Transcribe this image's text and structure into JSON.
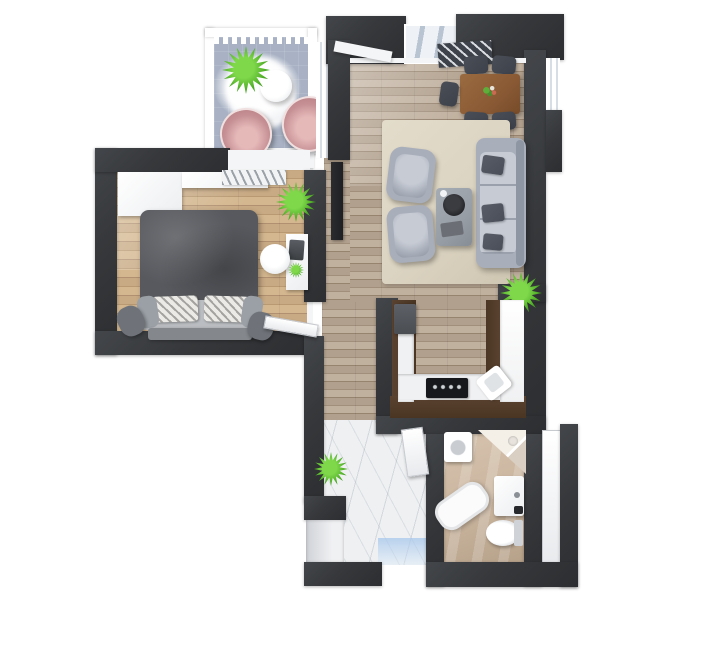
{
  "scene": {
    "type": "3d-floor-plan",
    "description": "Top-down 3D rendered floor plan of a one-bedroom apartment with balcony, bedroom, open living-dining room, U-shaped kitchen, hallway and bathroom on a white background"
  },
  "colors": {
    "wall": "#36383b",
    "trim_white": "#f4f5f6",
    "wood_bedroom": "#c8aa84",
    "wood_bedroom_dark": "#b89972",
    "wood_living": "#b1a08d",
    "wood_living_dark": "#a18f7c",
    "marble_white": "#eef0f2",
    "bath_tile": "#c9b49e",
    "balcony_floor": "#a8b2c4",
    "cabinet_brown": "#4a3523",
    "counter_white": "#f0f1f2",
    "rug_cream": "#dcd4c2",
    "rug_dark": "#3e424a",
    "sofa_gray": "#a8aeba",
    "sofa_shadow": "#8f96a3",
    "pillow_dark": "#4a4e58",
    "table_wood": "#8a5a35",
    "chair_dark": "#3d414a",
    "bed_duvet": "#57595e",
    "bed_light": "#babdc1",
    "chair_pink": "#c58f93",
    "chair_pink_dark": "#b47a80",
    "plant_green": "#4aa823",
    "plant_green_light": "#7fd84a",
    "appliance_dark": "#4a4e53",
    "cooktop_black": "#17181b"
  },
  "rooms": [
    {
      "name": "balcony",
      "items": [
        "railing",
        "potted-plant",
        "white-fluffy-rug",
        "round-side-table",
        "pink-lounge-chair",
        "pink-lounge-chair"
      ]
    },
    {
      "name": "bedroom",
      "items": [
        "wardrobe",
        "shelf",
        "clothes-rack",
        "double-bed",
        "patterned-pillows",
        "foot-bench",
        "pouf",
        "pouf",
        "desk",
        "laptop",
        "desk-chair",
        "desk-plant",
        "potted-plant",
        "door"
      ]
    },
    {
      "name": "living-dining-room",
      "items": [
        "wall-tv",
        "window-sill",
        "striped-runner-rug",
        "dining-table",
        "flower-centerpiece",
        "dining-chair",
        "dining-chair",
        "dining-chair",
        "dining-chair",
        "dining-chair",
        "cream-area-rug",
        "sofa",
        "throw-pillow",
        "throw-pillow",
        "throw-pillow",
        "armchair",
        "armchair",
        "coffee-table",
        "round-tray",
        "book",
        "potted-plant",
        "windows"
      ]
    },
    {
      "name": "kitchen",
      "items": [
        "u-shaped-cabinets",
        "marble-countertop",
        "built-in-appliance",
        "cooktop",
        "corner-sink"
      ]
    },
    {
      "name": "hallway",
      "items": [
        "marble-floor",
        "potted-plant",
        "entry-door",
        "bathroom-door"
      ]
    },
    {
      "name": "bathroom",
      "items": [
        "washing-machine",
        "corner-shower",
        "vanity-sink",
        "toilet",
        "bathtub",
        "side-door"
      ]
    }
  ]
}
